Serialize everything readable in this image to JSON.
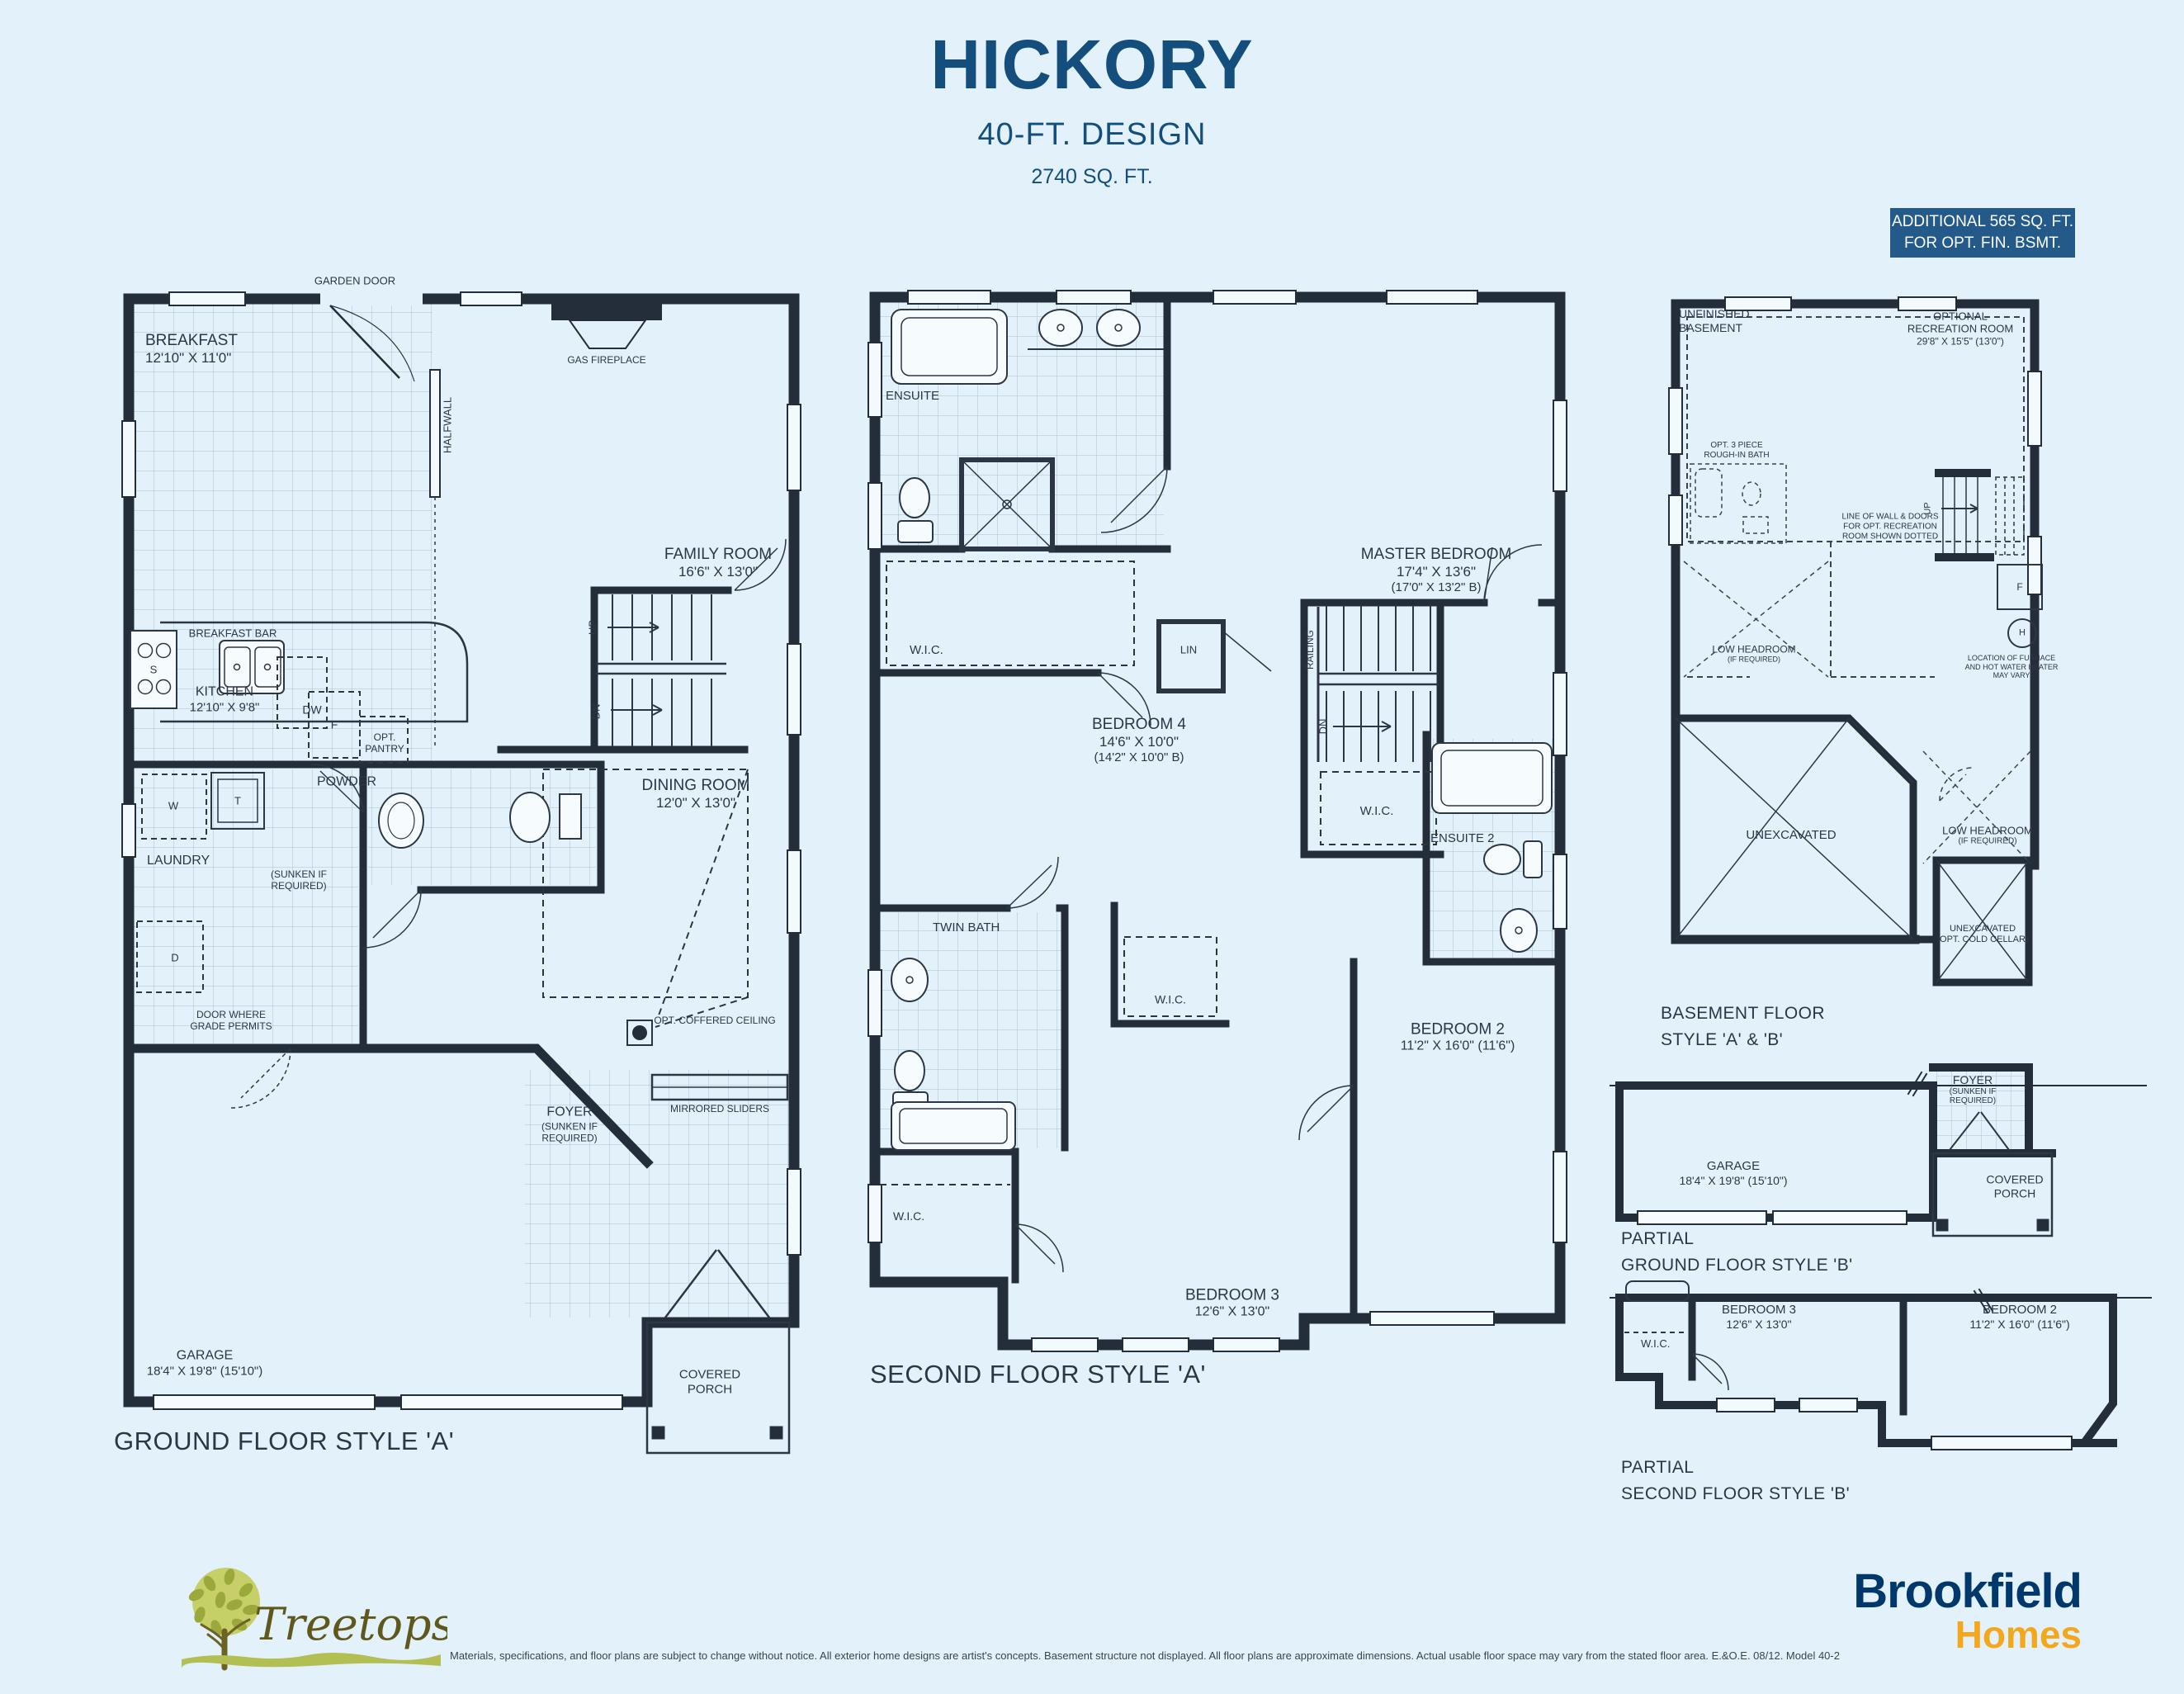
{
  "header": {
    "title": "HICKORY",
    "subtitle": "40-FT. DESIGN",
    "sqft": "2740 SQ. FT.",
    "badge_line1": "ADDITIONAL 565 SQ. FT.",
    "badge_line2": "FOR OPT. FIN. BSMT."
  },
  "colors": {
    "accent_blue": "#134e7d",
    "badge_bg": "#235a89",
    "wall_dark": "#242e3b",
    "background": "#e3f2fa",
    "brookfield_navy": "#00386b",
    "brookfield_gold": "#f2a71d",
    "treetops_olive": "#5e581d",
    "treetops_leaf": "#b6c155"
  },
  "ground": {
    "title": "GROUND FLOOR STYLE 'A'",
    "labels": {
      "garden_door": "GARDEN DOOR",
      "breakfast_name": "BREAKFAST",
      "breakfast_dims": "12'10\" X 11'0\"",
      "gas_fireplace": "GAS FIREPLACE",
      "halfwall": "HALFWALL",
      "family_name": "FAMILY ROOM",
      "family_dims": "16'6\" X 13'0\"",
      "breakfast_bar": "BREAKFAST BAR",
      "dw": "DW",
      "s": "S",
      "f": "F",
      "w": "W",
      "t": "T",
      "d": "D",
      "kitchen_name": "KITCHEN",
      "kitchen_dims": "12'10\" X 9'8\"",
      "opt_pantry1": "OPT.",
      "opt_pantry2": "PANTRY",
      "powder": "POWDER",
      "laundry": "LAUNDRY",
      "sunken1": "(SUNKEN IF",
      "sunken2": "REQUIRED)",
      "up": "UP",
      "dn": "DN",
      "dining_name": "DINING ROOM",
      "dining_dims": "12'0\" X 13'0\"",
      "door_grade1": "DOOR WHERE",
      "door_grade2": "GRADE PERMITS",
      "coffered": "OPT. COFFERED CEILING",
      "foyer_name": "FOYER",
      "foyer_note1": "(SUNKEN IF",
      "foyer_note2": "REQUIRED)",
      "mirrored": "MIRRORED SLIDERS",
      "garage_name": "GARAGE",
      "garage_dims": "18'4\" X 19'8\" (15'10\")",
      "porch1": "COVERED",
      "porch2": "PORCH"
    }
  },
  "second": {
    "title": "SECOND FLOOR STYLE 'A'",
    "labels": {
      "ensuite": "ENSUITE",
      "wic": "W.I.C.",
      "lin": "LIN",
      "master_name": "MASTER BEDROOM",
      "master_dims": "17'4\" X 13'6\"",
      "master_alt": "(17'0\" X 13'2\" B)",
      "railing": "RAILING",
      "dn": "DN",
      "bed4_name": "BEDROOM 4",
      "bed4_dims": "14'6\" X 10'0\"",
      "bed4_alt": "(14'2\" X 10'0\" B)",
      "twin_bath": "TWIN BATH",
      "ensuite2": "ENSUITE 2",
      "bed2_name": "BEDROOM 2",
      "bed2_dims": "11'2\" X 16'0\" (11'6\")",
      "bed3_name": "BEDROOM 3",
      "bed3_dims": "12'6\" X 13'0\""
    }
  },
  "basement": {
    "title1": "BASEMENT FLOOR",
    "title2": "STYLE 'A' & 'B'",
    "labels": {
      "unfinished1": "UNFINISHED",
      "unfinished2": "BASEMENT",
      "optrec1": "OPTIONAL",
      "optrec2": "RECREATION ROOM",
      "optrec3": "29'8\" X 15'5\" (13'0\")",
      "bath1": "OPT. 3 PIECE",
      "bath2": "ROUGH-IN BATH",
      "line1": "LINE OF WALL & DOORS",
      "line2": "FOR OPT. RECREATION",
      "line3": "ROOM SHOWN DOTTED",
      "up": "UP",
      "f": "F",
      "h": "H",
      "furnace1": "LOCATION OF FURNACE",
      "furnace2": "AND HOT WATER HEATER",
      "furnace3": "MAY VARY",
      "lowhead1": "LOW HEADROOM",
      "lowhead2": "(IF REQUIRED)",
      "unexcavated": "UNEXCAVATED",
      "cold1": "UNEXCAVATED",
      "cold2": "(OPT. COLD CELLAR)"
    }
  },
  "partial_ground": {
    "title1": "PARTIAL",
    "title2": "GROUND FLOOR STYLE 'B'",
    "labels": {
      "foyer1": "FOYER",
      "foyer2": "(SUNKEN IF",
      "foyer3": "REQUIRED)",
      "garage_name": "GARAGE",
      "garage_dims": "18'4\" X 19'8\" (15'10\")",
      "porch1": "COVERED",
      "porch2": "PORCH"
    }
  },
  "partial_second": {
    "title1": "PARTIAL",
    "title2": "SECOND FLOOR STYLE 'B'",
    "labels": {
      "wic": "W.I.C.",
      "bed3_name": "BEDROOM 3",
      "bed3_dims": "12'6\" X 13'0\"",
      "bed2_name": "BEDROOM 2",
      "bed2_dims": "11'2\" X 16'0\" (11'6\")"
    }
  },
  "footer": {
    "treetops": "Treetops",
    "brookfield": "Brookfield",
    "homes": "Homes",
    "disclaimer": "Materials, specifications, and floor plans are subject to change without notice. All exterior home designs are artist's concepts. Basement structure not displayed. All floor plans are approximate dimensions. Actual usable floor space may vary from the stated floor area. E.&O.E. 08/12. Model 40-2"
  }
}
